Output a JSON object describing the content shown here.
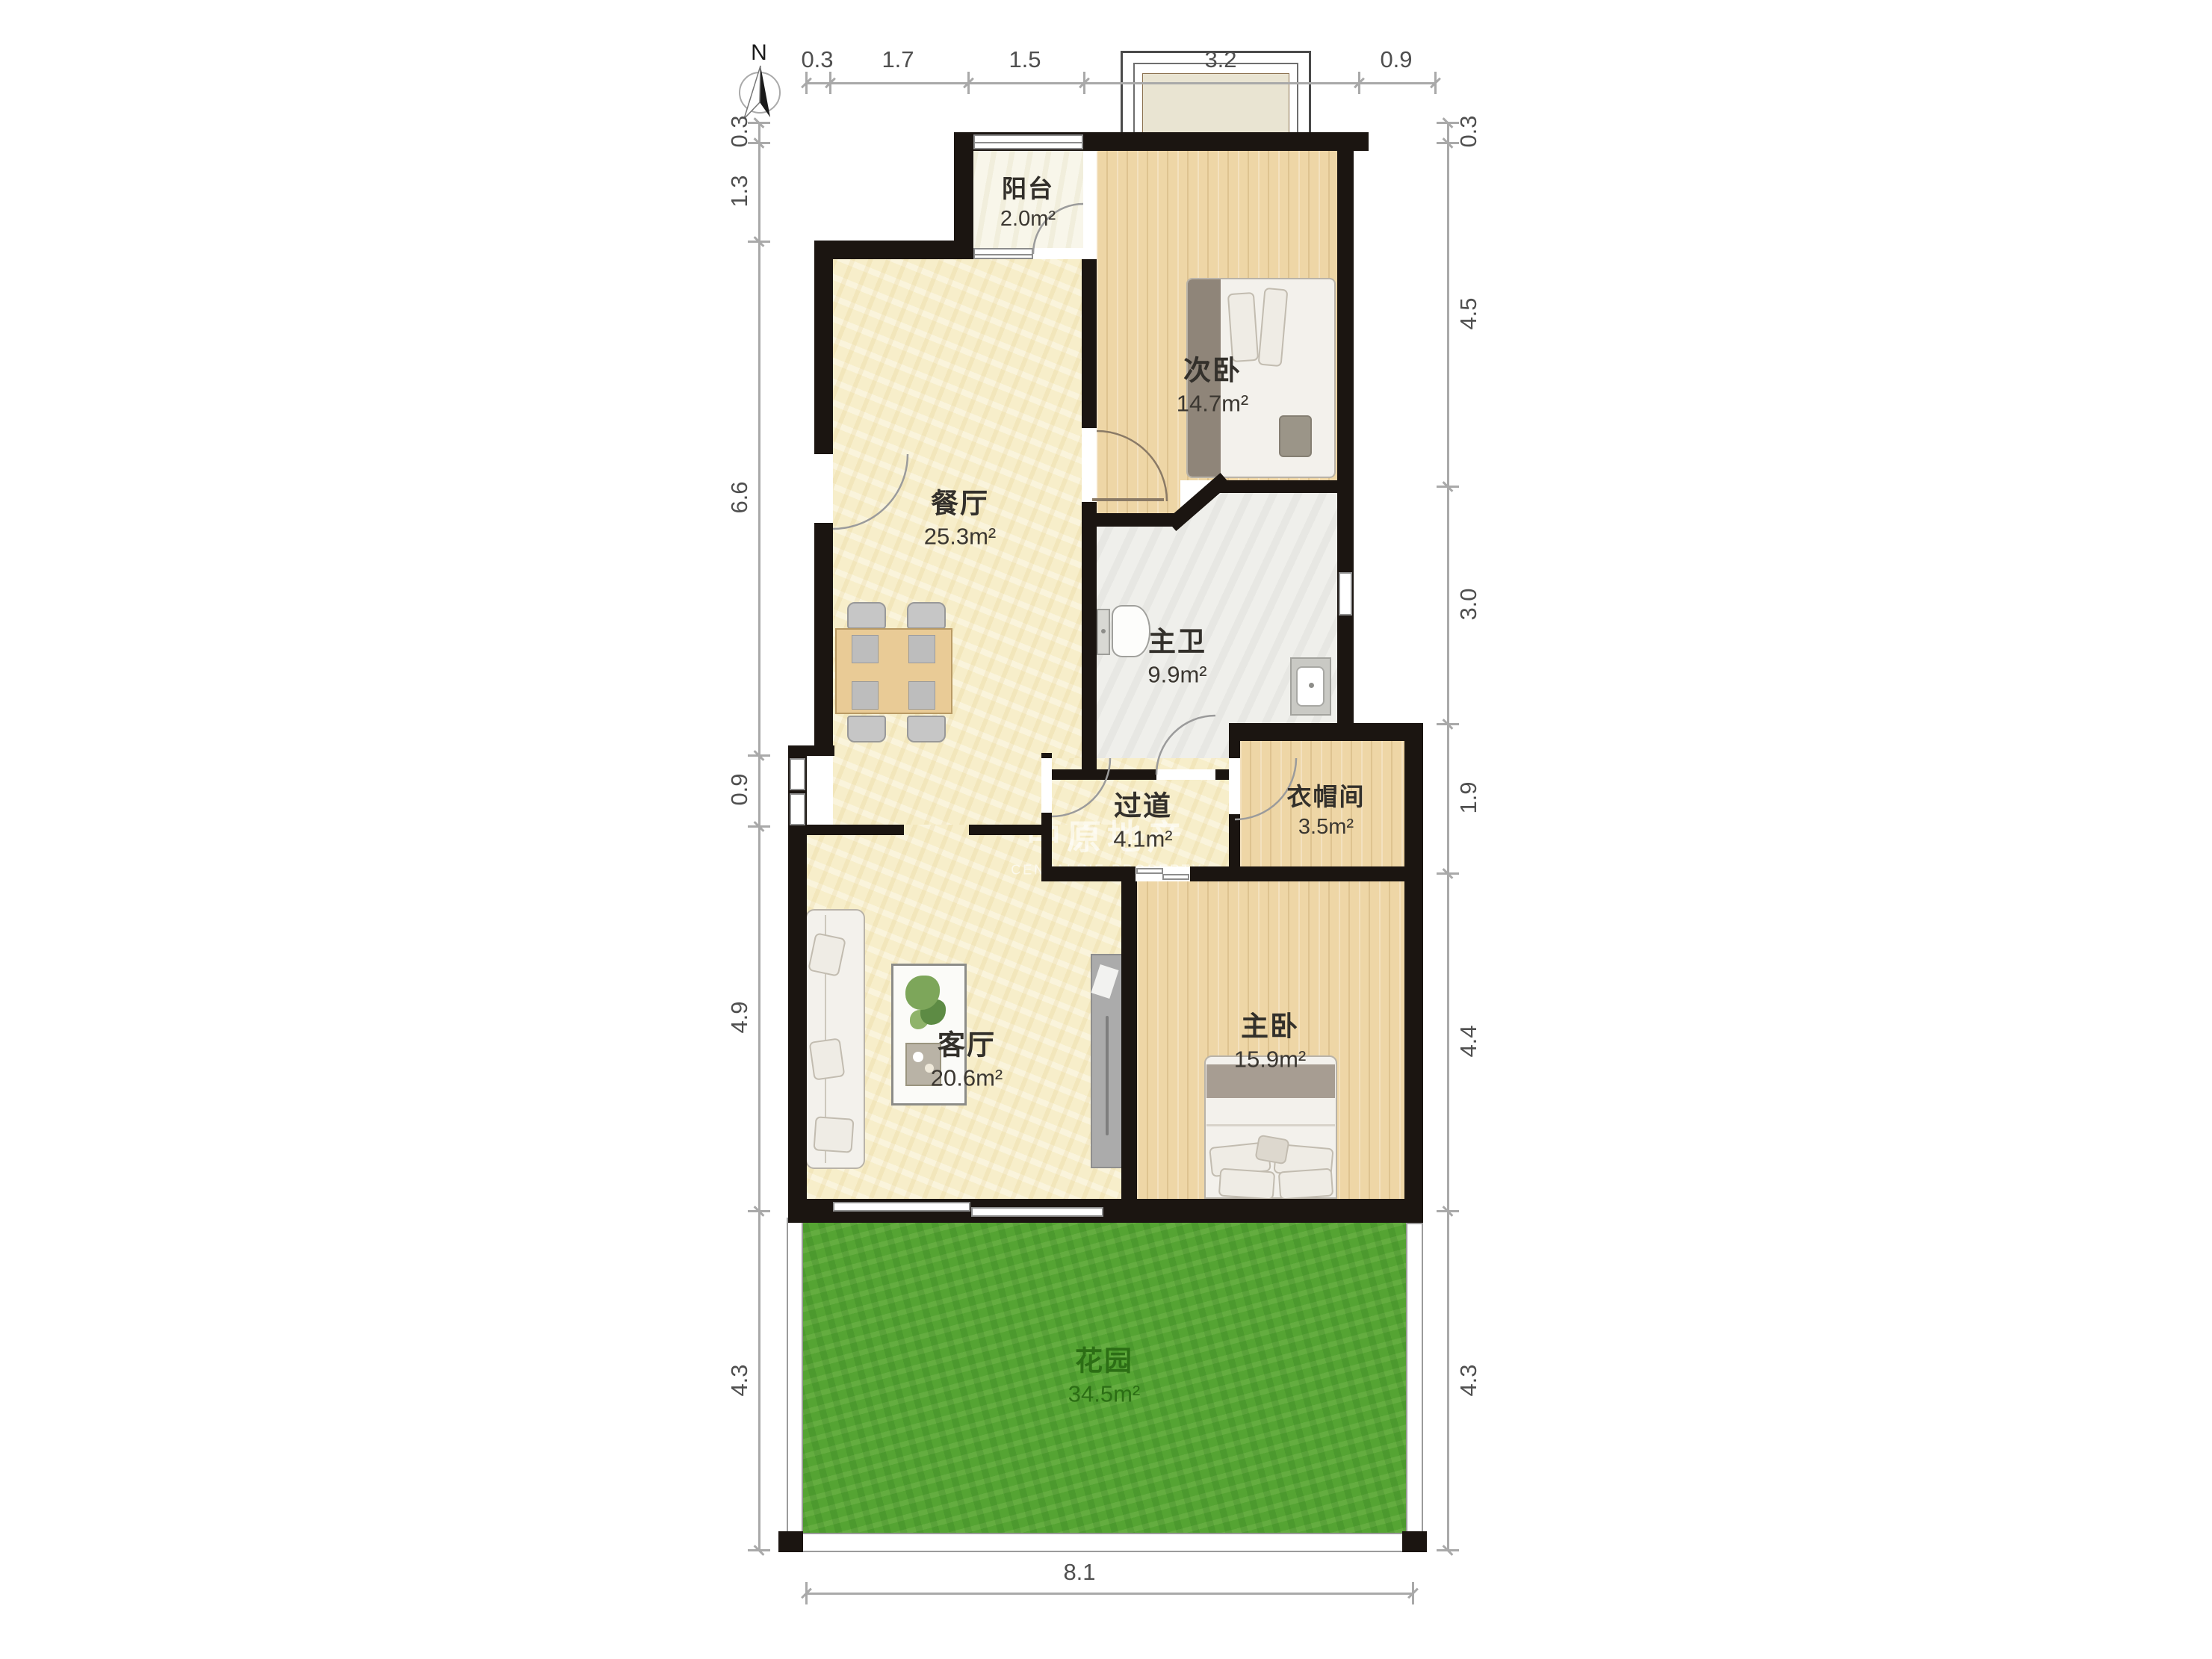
{
  "compass": {
    "north_label": "N"
  },
  "watermark": {
    "line1": "中原地产",
    "line2": "CENTALINE PROPERTY"
  },
  "rooms": [
    {
      "id": "balcony",
      "name": "阳台",
      "area": "2.0m²"
    },
    {
      "id": "second-bedroom",
      "name": "次卧",
      "area": "14.7m²"
    },
    {
      "id": "dining-room",
      "name": "餐厅",
      "area": "25.3m²"
    },
    {
      "id": "master-bathroom",
      "name": "主卫",
      "area": "9.9m²"
    },
    {
      "id": "hallway",
      "name": "过道",
      "area": "4.1m²"
    },
    {
      "id": "walk-in-closet",
      "name": "衣帽间",
      "area": "3.5m²"
    },
    {
      "id": "living-room",
      "name": "客厅",
      "area": "20.6m²"
    },
    {
      "id": "master-bedroom",
      "name": "主卧",
      "area": "15.9m²"
    },
    {
      "id": "garden",
      "name": "花园",
      "area": "34.5m²"
    }
  ],
  "dimensions": {
    "top": [
      "0.3",
      "1.7",
      "1.5",
      "3.2",
      "0.9"
    ],
    "left": [
      "0.3",
      "1.3",
      "6.6",
      "0.9",
      "4.9",
      "4.3"
    ],
    "right": [
      "0.3",
      "4.5",
      "3.0",
      "1.9",
      "4.4",
      "4.3"
    ],
    "bottom": [
      "8.1"
    ]
  }
}
